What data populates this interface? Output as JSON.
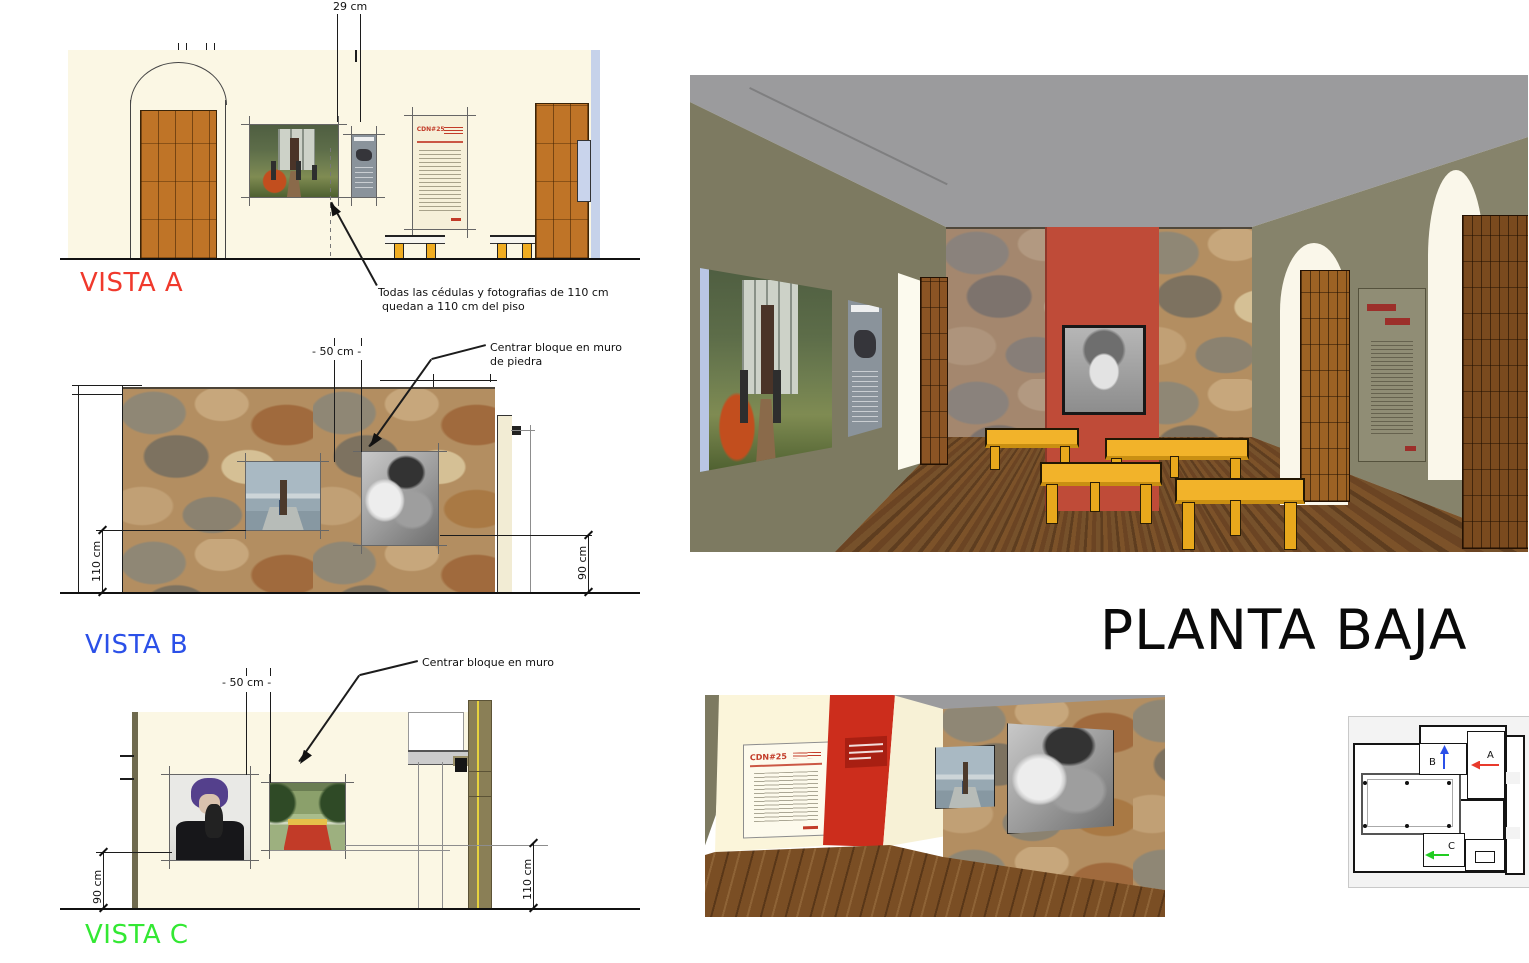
{
  "page_title": {
    "text": "PLANTA BAJA"
  },
  "vistas": {
    "a": {
      "label": "VISTA A",
      "dim_top": "29 cm",
      "note_line1": "Todas las cédulas y fotografias de 110 cm",
      "note_line2": "quedan a 110 cm del piso"
    },
    "b": {
      "label": "VISTA B",
      "dim_top": "- 50 cm -",
      "dim_left": "110 cm",
      "dim_right": "90 cm",
      "note_line1": "Centrar bloque en muro",
      "note_line2": "de piedra"
    },
    "c": {
      "label": "VISTA C",
      "dim_top": "- 50 cm -",
      "dim_left": "90 cm",
      "dim_right": "110 cm",
      "note_line1": "Centrar bloque en muro"
    }
  },
  "posters": {
    "cdn_title": "CDN#25"
  },
  "floor_plan": {
    "room_a": "A",
    "room_b": "B",
    "room_c": "C"
  },
  "colors": {
    "vista_a_label": "#f0392c",
    "vista_b_label": "#2b50e8",
    "vista_c_label": "#33e833",
    "accent_red": "#bf4b38",
    "accent_red_bright": "#cc2d1c",
    "door_brown": "#bf7427",
    "bench_yellow": "#f0ad21",
    "wall_cream": "#fbf7e4",
    "wall_olive": "#7e7b62",
    "ceiling_gray": "#9b9b9d",
    "floor_wood": "#6f4a26",
    "poster_red": "#c23b28",
    "plan_arrow_a": "#e83a2c",
    "plan_arrow_b": "#2b50e8",
    "plan_arrow_c": "#22cc22"
  }
}
